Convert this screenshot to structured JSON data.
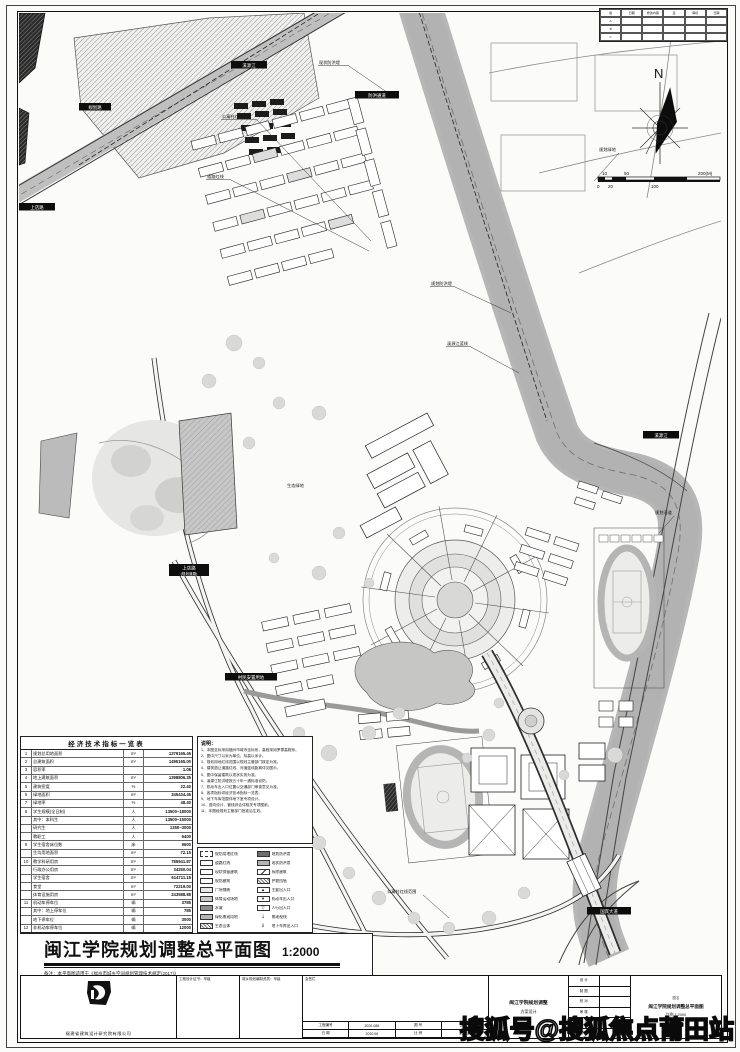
{
  "watermark": "搜狐号@搜狐焦点莆田站",
  "north": {
    "label": "N"
  },
  "scale_bar": {
    "ticks": [
      "10",
      "50",
      "200(M)",
      "0",
      "20",
      "100"
    ]
  },
  "revision_table": {
    "cells": [
      "版",
      "日期",
      "修改内容",
      "签",
      "审核",
      "日期",
      "A",
      "",
      "",
      "",
      "",
      "",
      "B",
      "",
      "",
      "",
      "",
      "",
      "C",
      "",
      "",
      "",
      "",
      ""
    ]
  },
  "indicators_table": {
    "title": "经济技术指标一览表",
    "rows": [
      {
        "n": "1",
        "name": "规划总用地面积",
        "u": "m²",
        "v": "1379165.46"
      },
      {
        "n": "2",
        "name": "总建筑面积",
        "u": "m²",
        "v": "1495165.00"
      },
      {
        "n": "3",
        "name": "容积率",
        "u": "",
        "v": "1.08"
      },
      {
        "n": "4",
        "name": "地上建筑面积",
        "u": "m²",
        "v": "1398806.35"
      },
      {
        "n": "5",
        "name": "建筑密度",
        "u": "%",
        "v": "22.40"
      },
      {
        "n": "6",
        "name": "绿地面积",
        "u": "m²",
        "v": "345434.46"
      },
      {
        "n": "7",
        "name": "绿地率",
        "u": "%",
        "v": "48.40"
      },
      {
        "n": "8",
        "name": "学生规模(全日制)",
        "u": "人",
        "v": "13500~18000"
      },
      {
        "n": "",
        "name": "其中：本科生",
        "u": "人",
        "v": "13500~15000"
      },
      {
        "n": "",
        "name": "研究生",
        "u": "人",
        "v": "1350~3000"
      },
      {
        "n": "",
        "name": "教职工",
        "u": "人",
        "v": "6400"
      },
      {
        "n": "9",
        "name": "学生宿舍床位数",
        "u": "床",
        "v": "9600"
      },
      {
        "n": "",
        "name": "生均用地面积",
        "u": "m²",
        "v": "72.15"
      },
      {
        "n": "10",
        "name": "教学科研用房",
        "u": "m²",
        "v": "785941.87"
      },
      {
        "n": "",
        "name": "行政办公用房",
        "u": "m²",
        "v": "34250.04"
      },
      {
        "n": "",
        "name": "学生宿舍",
        "u": "m²",
        "v": "614711.18"
      },
      {
        "n": "",
        "name": "食堂",
        "u": "m²",
        "v": "72219.00"
      },
      {
        "n": "",
        "name": "体育设施用房",
        "u": "m²",
        "v": "243588.88"
      },
      {
        "n": "11",
        "name": "机动车停车位",
        "u": "辆",
        "v": "3785"
      },
      {
        "n": "",
        "name": "其中：地上停车位",
        "u": "辆",
        "v": "785"
      },
      {
        "n": "",
        "name": "地下停车位",
        "u": "辆",
        "v": "3000"
      },
      {
        "n": "12",
        "name": "非机动车停车位",
        "u": "辆",
        "v": "12000"
      }
    ]
  },
  "notes": {
    "title": "说明：",
    "lines": [
      "1、本图坐标采用福州市城市坐标系，高程采用罗零高程系。",
      "2、图中尺寸以米为单位，标高以米计。",
      "3、规划用地红线范围以规划主管部门核定为准。",
      "4、建筑退让道路红线、河道蓝线距离详见图示。",
      "5、图中保留建筑以现状实测为准。",
      "6、溪源江防洪堤按五十年一遇标准设防。",
      "7、机动车出入口位置以交通部门审查意见为准。",
      "8、各项指标详经济技术指标一览表。",
      "9、地下车库范围详地下室专项设计。",
      "10、竖向设计、管线综合详相关专项图纸。",
      "11、本图经规划主管部门批准后生效。"
    ]
  },
  "legend": {
    "left": [
      {
        "label": "规划用地红线",
        "swatch": "s-dashb",
        "glyph": ""
      },
      {
        "label": "道路红线",
        "swatch": "",
        "glyph": ""
      },
      {
        "label": "现状保留建筑",
        "swatch": "",
        "glyph": ""
      },
      {
        "label": "规划建筑",
        "swatch": "",
        "glyph": ""
      },
      {
        "label": "广场铺装",
        "swatch": "s-light",
        "glyph": ""
      },
      {
        "label": "体育运动场地",
        "swatch": "s-mid",
        "glyph": ""
      },
      {
        "label": "水域",
        "swatch": "s-dark",
        "glyph": ""
      },
      {
        "label": "绿化景观用地",
        "swatch": "s-midfill",
        "glyph": ""
      },
      {
        "label": "生态山体",
        "swatch": "s-hatch",
        "glyph": ""
      }
    ],
    "right": [
      {
        "label": "规划防洪堤",
        "swatch": "s-darkfill",
        "glyph": ""
      },
      {
        "label": "现状防洪堤",
        "swatch": "s-midfill",
        "glyph": ""
      },
      {
        "label": "拆除建筑",
        "swatch": "s-diag",
        "glyph": ""
      },
      {
        "label": "护坡挡墙",
        "swatch": "s-hatch",
        "glyph": ""
      },
      {
        "label": "主要出入口",
        "swatch": "",
        "glyph": "▲"
      },
      {
        "label": "机动车出入口",
        "swatch": "",
        "glyph": "▼"
      },
      {
        "label": "人行出入口",
        "swatch": "",
        "glyph": "▽"
      },
      {
        "label": "景观视线",
        "swatch": "s-nobox",
        "glyph": "⇣"
      },
      {
        "label": "地下车库出入口",
        "swatch": "s-nobox",
        "glyph": "⇓"
      }
    ]
  },
  "main_title": {
    "title": "闽江学院规划调整总平面图",
    "scale": "1:2000",
    "note": "备注：本平面图适用于《福州市城乡空间规划管理技术规定(2017)》"
  },
  "strip": {
    "company": "福建省建筑设计研究院有限公司",
    "cert1": "工程设计证书：甲级",
    "cert2": "城乡规划编制资质：甲级",
    "sign_header": "会签栏",
    "info_cells": [
      "工程编号",
      "2020-086",
      "图 号",
      "JS-01",
      "日 期",
      "2020.06",
      "比 例",
      "1:2000"
    ],
    "project_line1": "闽江学院规划调整",
    "project_line2": "方案设计",
    "roles": [
      "设 计",
      "制 图",
      "校 对",
      "审 核",
      "审 定",
      "项目负责"
    ],
    "name_label": "图名",
    "name": "闽江学院规划调整总平面图",
    "name_scale": "比例 1:2000"
  },
  "map": {
    "tags": [
      {
        "text": "规划路"
      },
      {
        "text": "上店路"
      },
      {
        "text": "溪源江"
      },
      {
        "text": "防洪通道"
      },
      {
        "text": "上店路",
        "text2": "(规划道路)"
      },
      {
        "text": "村民安置用地"
      },
      {
        "text": "溪源江"
      },
      {
        "text": "国宾大道"
      }
    ],
    "labels": [
      {
        "text": "现状防洪堤"
      },
      {
        "text": "公寓村红线范围"
      },
      {
        "text": "道路红线"
      },
      {
        "text": "规划防洪堤"
      },
      {
        "text": "溪源江蓝线"
      },
      {
        "text": "规划绿地"
      },
      {
        "text": "规划河道"
      },
      {
        "text": "公寓村红线范围"
      },
      {
        "text": "生态绿地"
      }
    ]
  }
}
